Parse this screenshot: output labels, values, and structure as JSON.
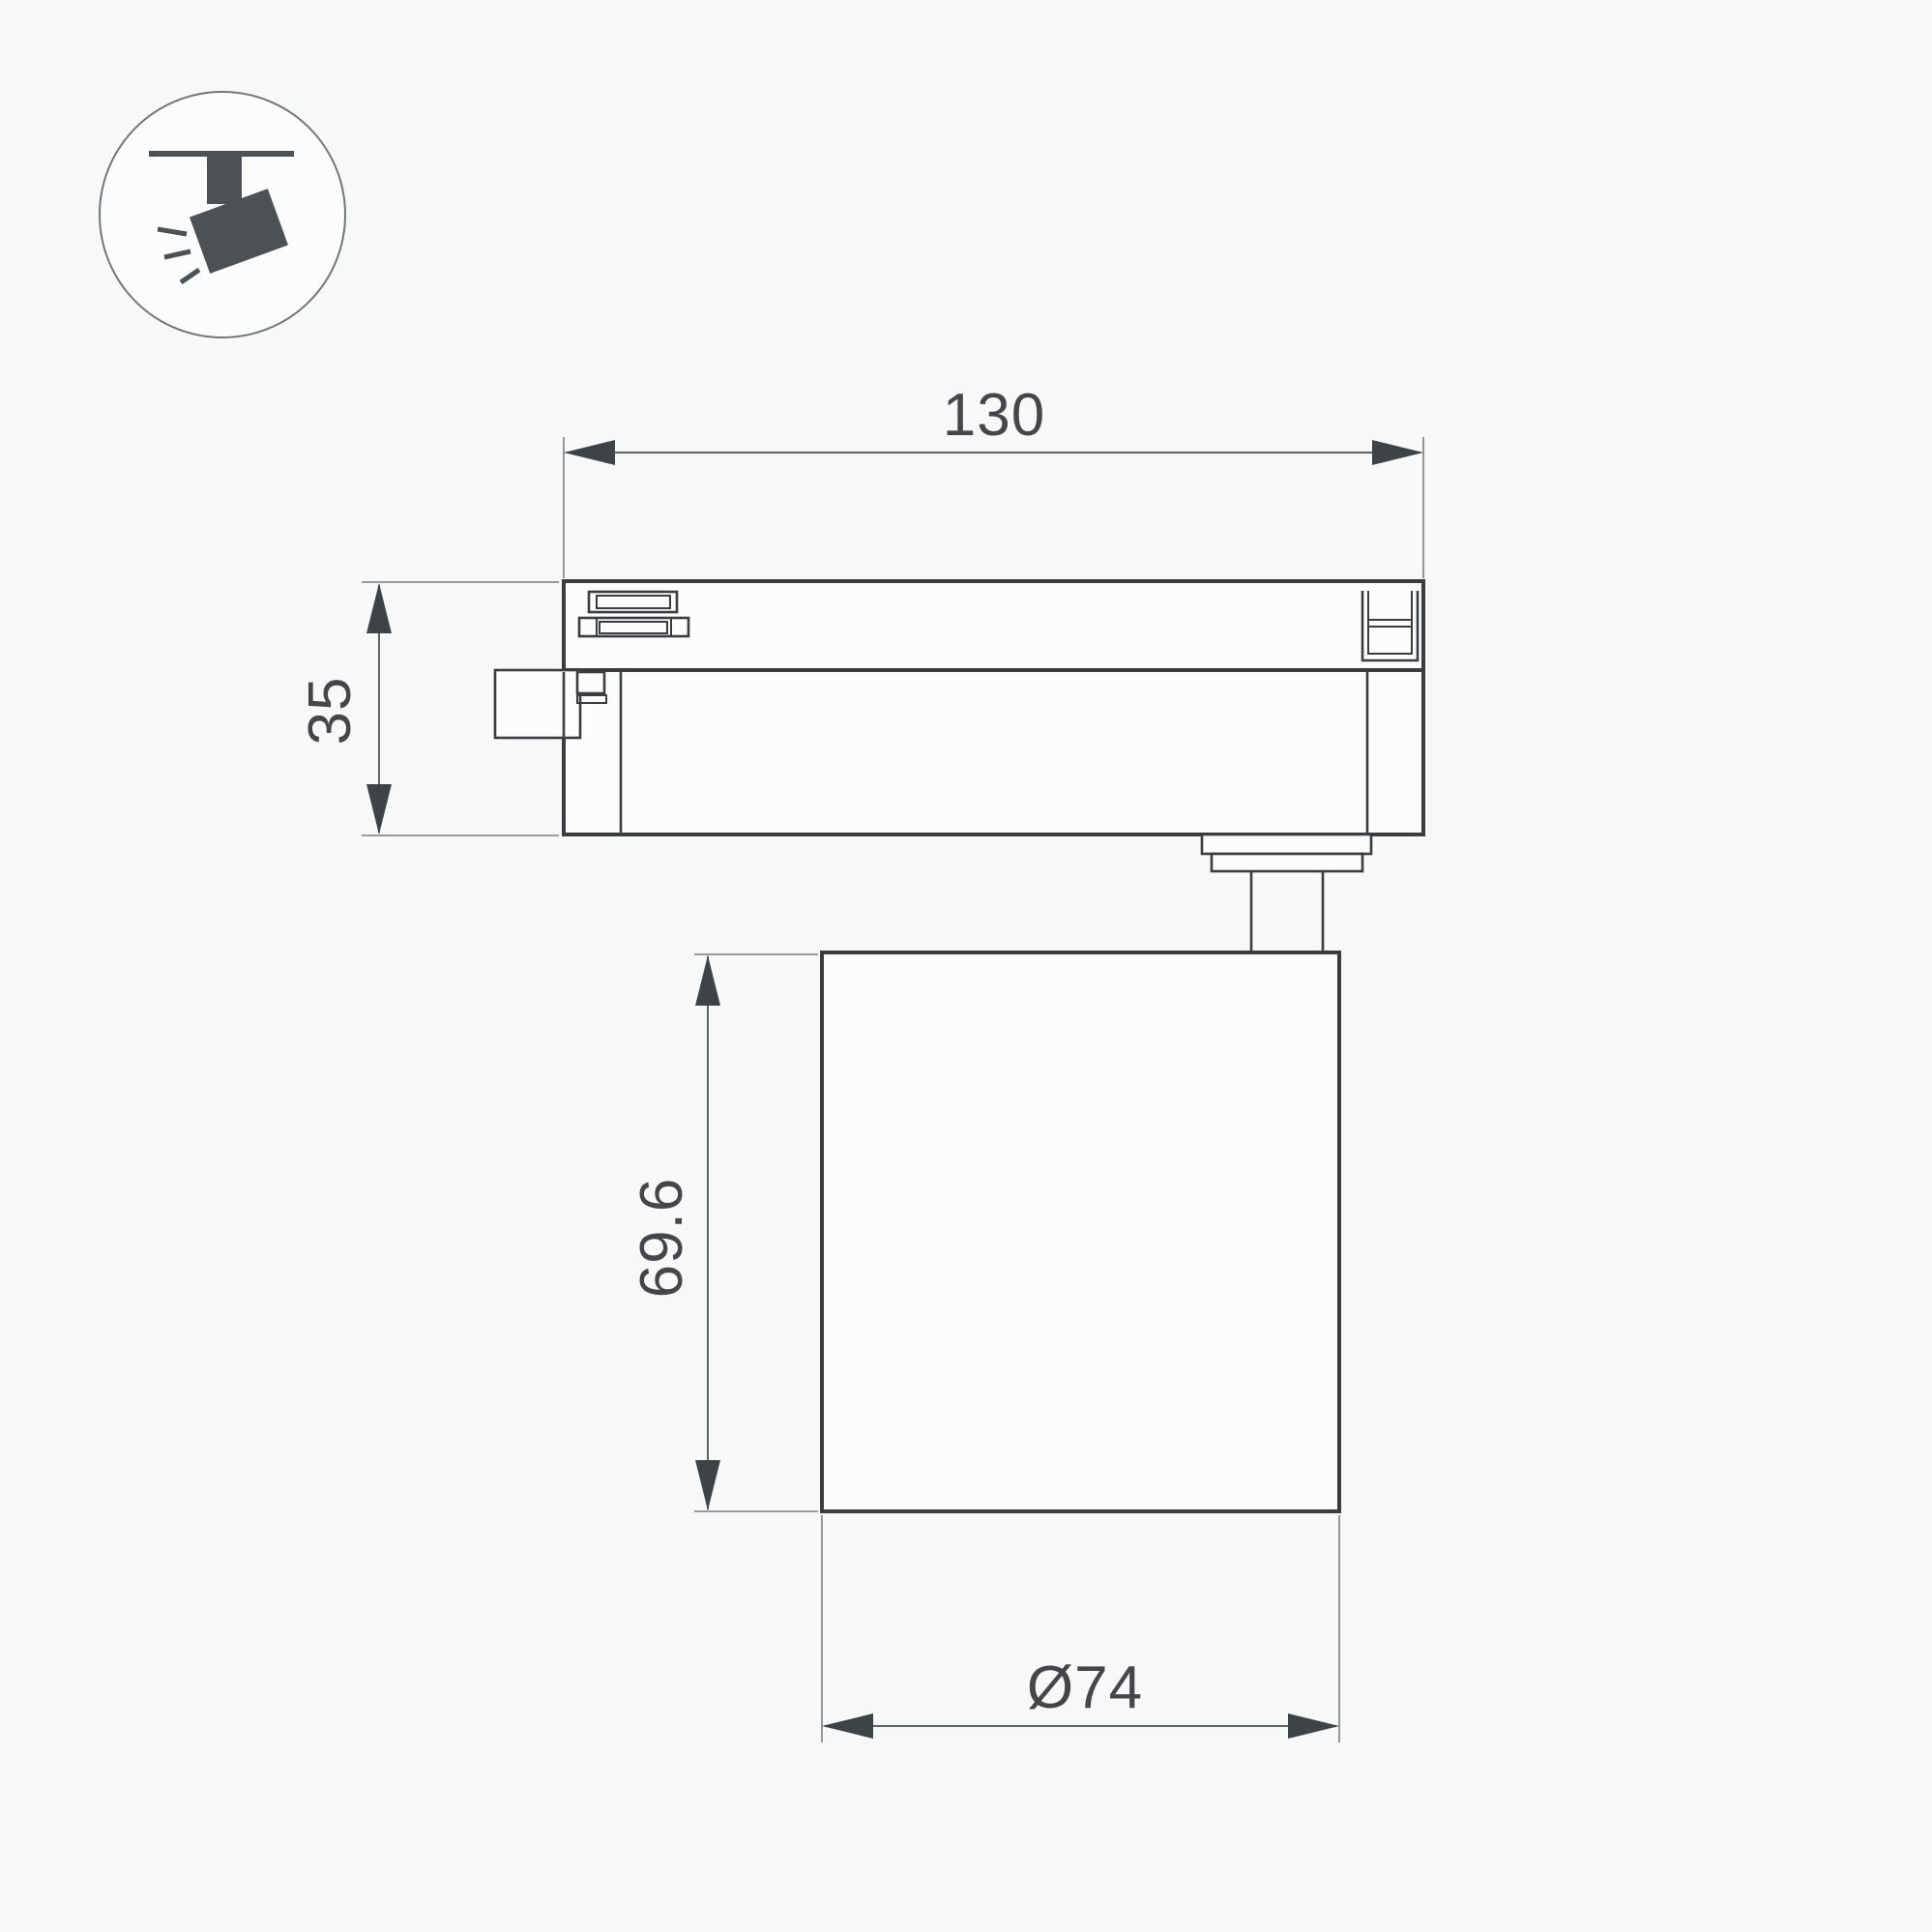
{
  "icon": {
    "name": "track-spotlight-icon"
  },
  "dimensions": {
    "track_length": {
      "label": "130"
    },
    "adapter_height": {
      "label": "35"
    },
    "body_height": {
      "label": "69.6"
    },
    "body_diameter": {
      "label": "Ø74"
    }
  },
  "colors": {
    "bg": "#f7f8f8",
    "fill": "#fcfcfd",
    "outline": "#393d40",
    "dim": "#5f6467",
    "ext": "#888c8f",
    "arrow": "#3e4347",
    "text": "#43474a",
    "icon": "#4b5155",
    "circle": "#71767a"
  }
}
